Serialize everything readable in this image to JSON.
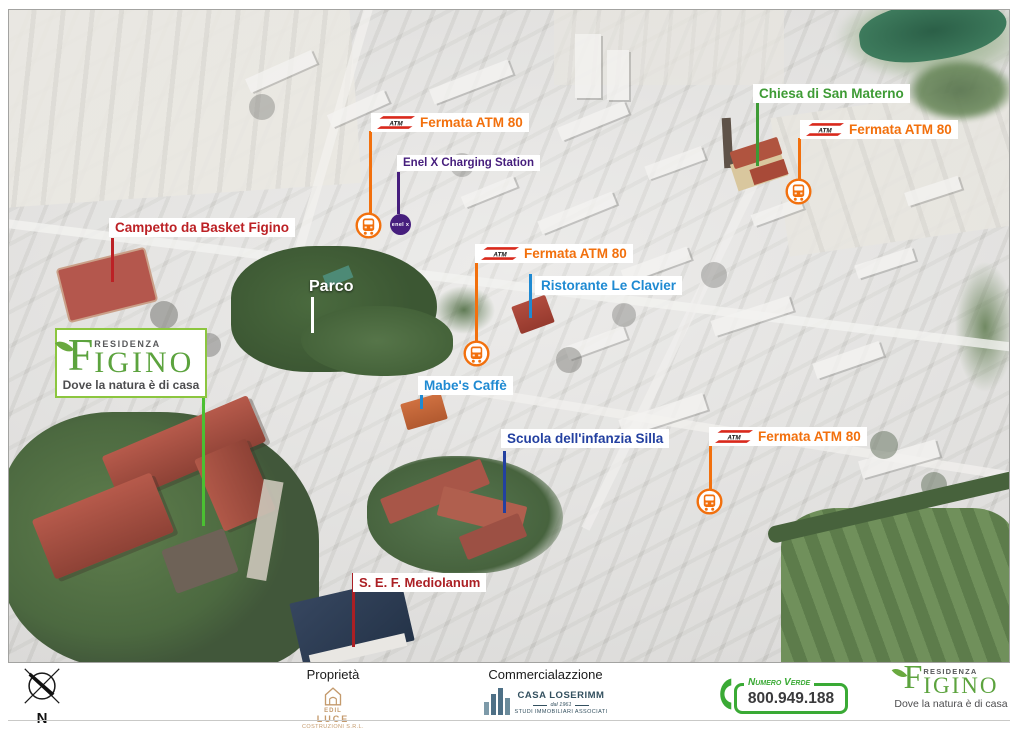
{
  "branding": {
    "residenza": "RESIDENZA",
    "initial": "F",
    "name_rest": "IGINO",
    "tagline": "Dove la natura è di casa"
  },
  "labels": {
    "fermata_atm": "Fermata ATM 80",
    "atm_badge": "ATM",
    "enel_station": "Enel X Charging Station",
    "enel_icon_text": "enel x",
    "chiesa": "Chiesa di San Materno",
    "campetto": "Campetto da Basket Figino",
    "parco": "Parco",
    "ristorante": "Ristorante Le Clavier",
    "mabes": "Mabe's Caffè",
    "scuola": "Scuola dell'infanzia Silla",
    "sef": "S. E. F. Mediolanum"
  },
  "compass": {
    "north_label": "N"
  },
  "footer": {
    "proprieta_heading": "Proprietà",
    "edil_luce": {
      "line1": "EDIL",
      "line2": "LUCE",
      "line3": "COSTRUZIONI S.R.L."
    },
    "commercializzazione_heading": "Commercialazzione",
    "casa_loserimm": {
      "name": "CASA LOSERIMM",
      "sub1": "dal 1961",
      "sub2": "STUDI IMMOBILIARI ASSOCIATI"
    },
    "numero_verde": {
      "label": "Numero Verde",
      "number": "800.949.188"
    }
  },
  "colors": {
    "atm_orange": "#F2700D",
    "label_green": "#3E9B35",
    "logo_green": "#5CA33E",
    "logo_border_green": "#8CC63F",
    "enel_purple": "#461E7D",
    "campetto_red": "#BC2125",
    "sef_red": "#AB1F24",
    "light_blue": "#1F8AD2",
    "dark_blue": "#2340A0",
    "numero_verde_green": "#3AAA35",
    "edil_tan": "#C49A6C",
    "casa_slate": "#4E7086"
  }
}
